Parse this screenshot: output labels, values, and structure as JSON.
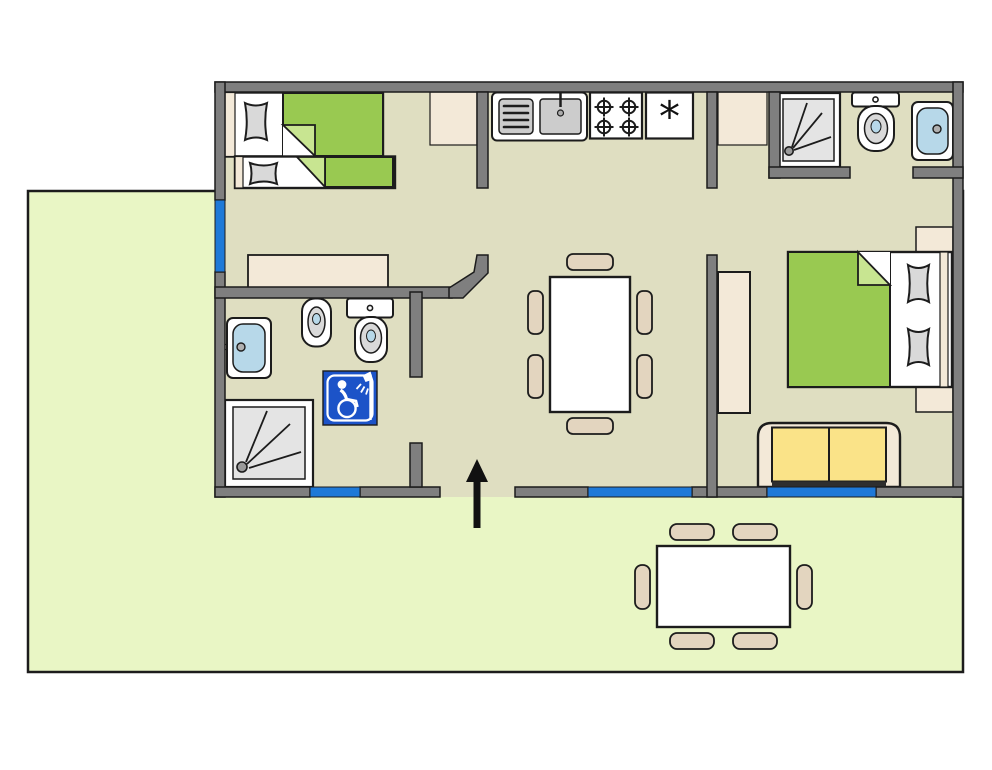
{
  "meta": {
    "scene": "bungalow-floor-plan-with-terrace",
    "visible_text": [
      "*"
    ]
  },
  "colors": {
    "ink": "#1c1c1c",
    "terrace": "#e9f6c5",
    "floor": "#dfdec1",
    "wall": "#7f7f7f",
    "window": "#1e79d8",
    "bed_green": "#99c951",
    "bed_green_light": "#c8e591",
    "beige": "#f3e9d8",
    "chair": "#e3d5bf",
    "sofa_yellow": "#fae388",
    "sink_blue": "#b7d8e9",
    "fixture_gray": "#cccccc",
    "shower_gray": "#e4e4e4",
    "pillow_gray": "#d9d9d9",
    "sign_blue": "#1c53c8",
    "arrow": "#111111"
  },
  "symbols": {
    "fridge": "*"
  },
  "icons": [
    "accessible-shower-sign",
    "entrance-arrow-icon",
    "stove-burner-icon",
    "shower-drain-icon",
    "fridge-asterisk"
  ],
  "rooms": [
    {
      "id": "bedroom-1",
      "label": "twin bedroom",
      "furniture": [
        "single-bed",
        "single-bed",
        "closet",
        "sideboard"
      ],
      "window_count": 1
    },
    {
      "id": "bathroom-1",
      "label": "accessible bathroom",
      "furniture": [
        "washbasin",
        "bidet",
        "toilet",
        "shower",
        "accessible-shower-sign"
      ],
      "window_count": 1
    },
    {
      "id": "kitchen",
      "label": "kitchenette",
      "furniture": [
        "counter",
        "sink-drainboard-unit",
        "stove-4-burner",
        "refrigerator"
      ]
    },
    {
      "id": "living-dining",
      "label": "living / dining room",
      "furniture": [
        "dining-table"
      ],
      "chair_count": 6,
      "window_count": 1
    },
    {
      "id": "bedroom-2",
      "label": "double bedroom",
      "furniture": [
        "double-bed",
        "nightstand",
        "nightstand",
        "wardrobe",
        "closet",
        "sofa"
      ],
      "window_count": 1
    },
    {
      "id": "bathroom-2",
      "label": "en-suite bathroom",
      "furniture": [
        "shower",
        "toilet",
        "washbasin"
      ]
    },
    {
      "id": "terrace",
      "label": "terrace / garden",
      "furniture": [
        "outdoor-table"
      ],
      "chair_count": 6
    }
  ],
  "openings": {
    "entrance": "bottom-center, marked with up arrow",
    "interior_doors": 4,
    "windows": 4
  }
}
